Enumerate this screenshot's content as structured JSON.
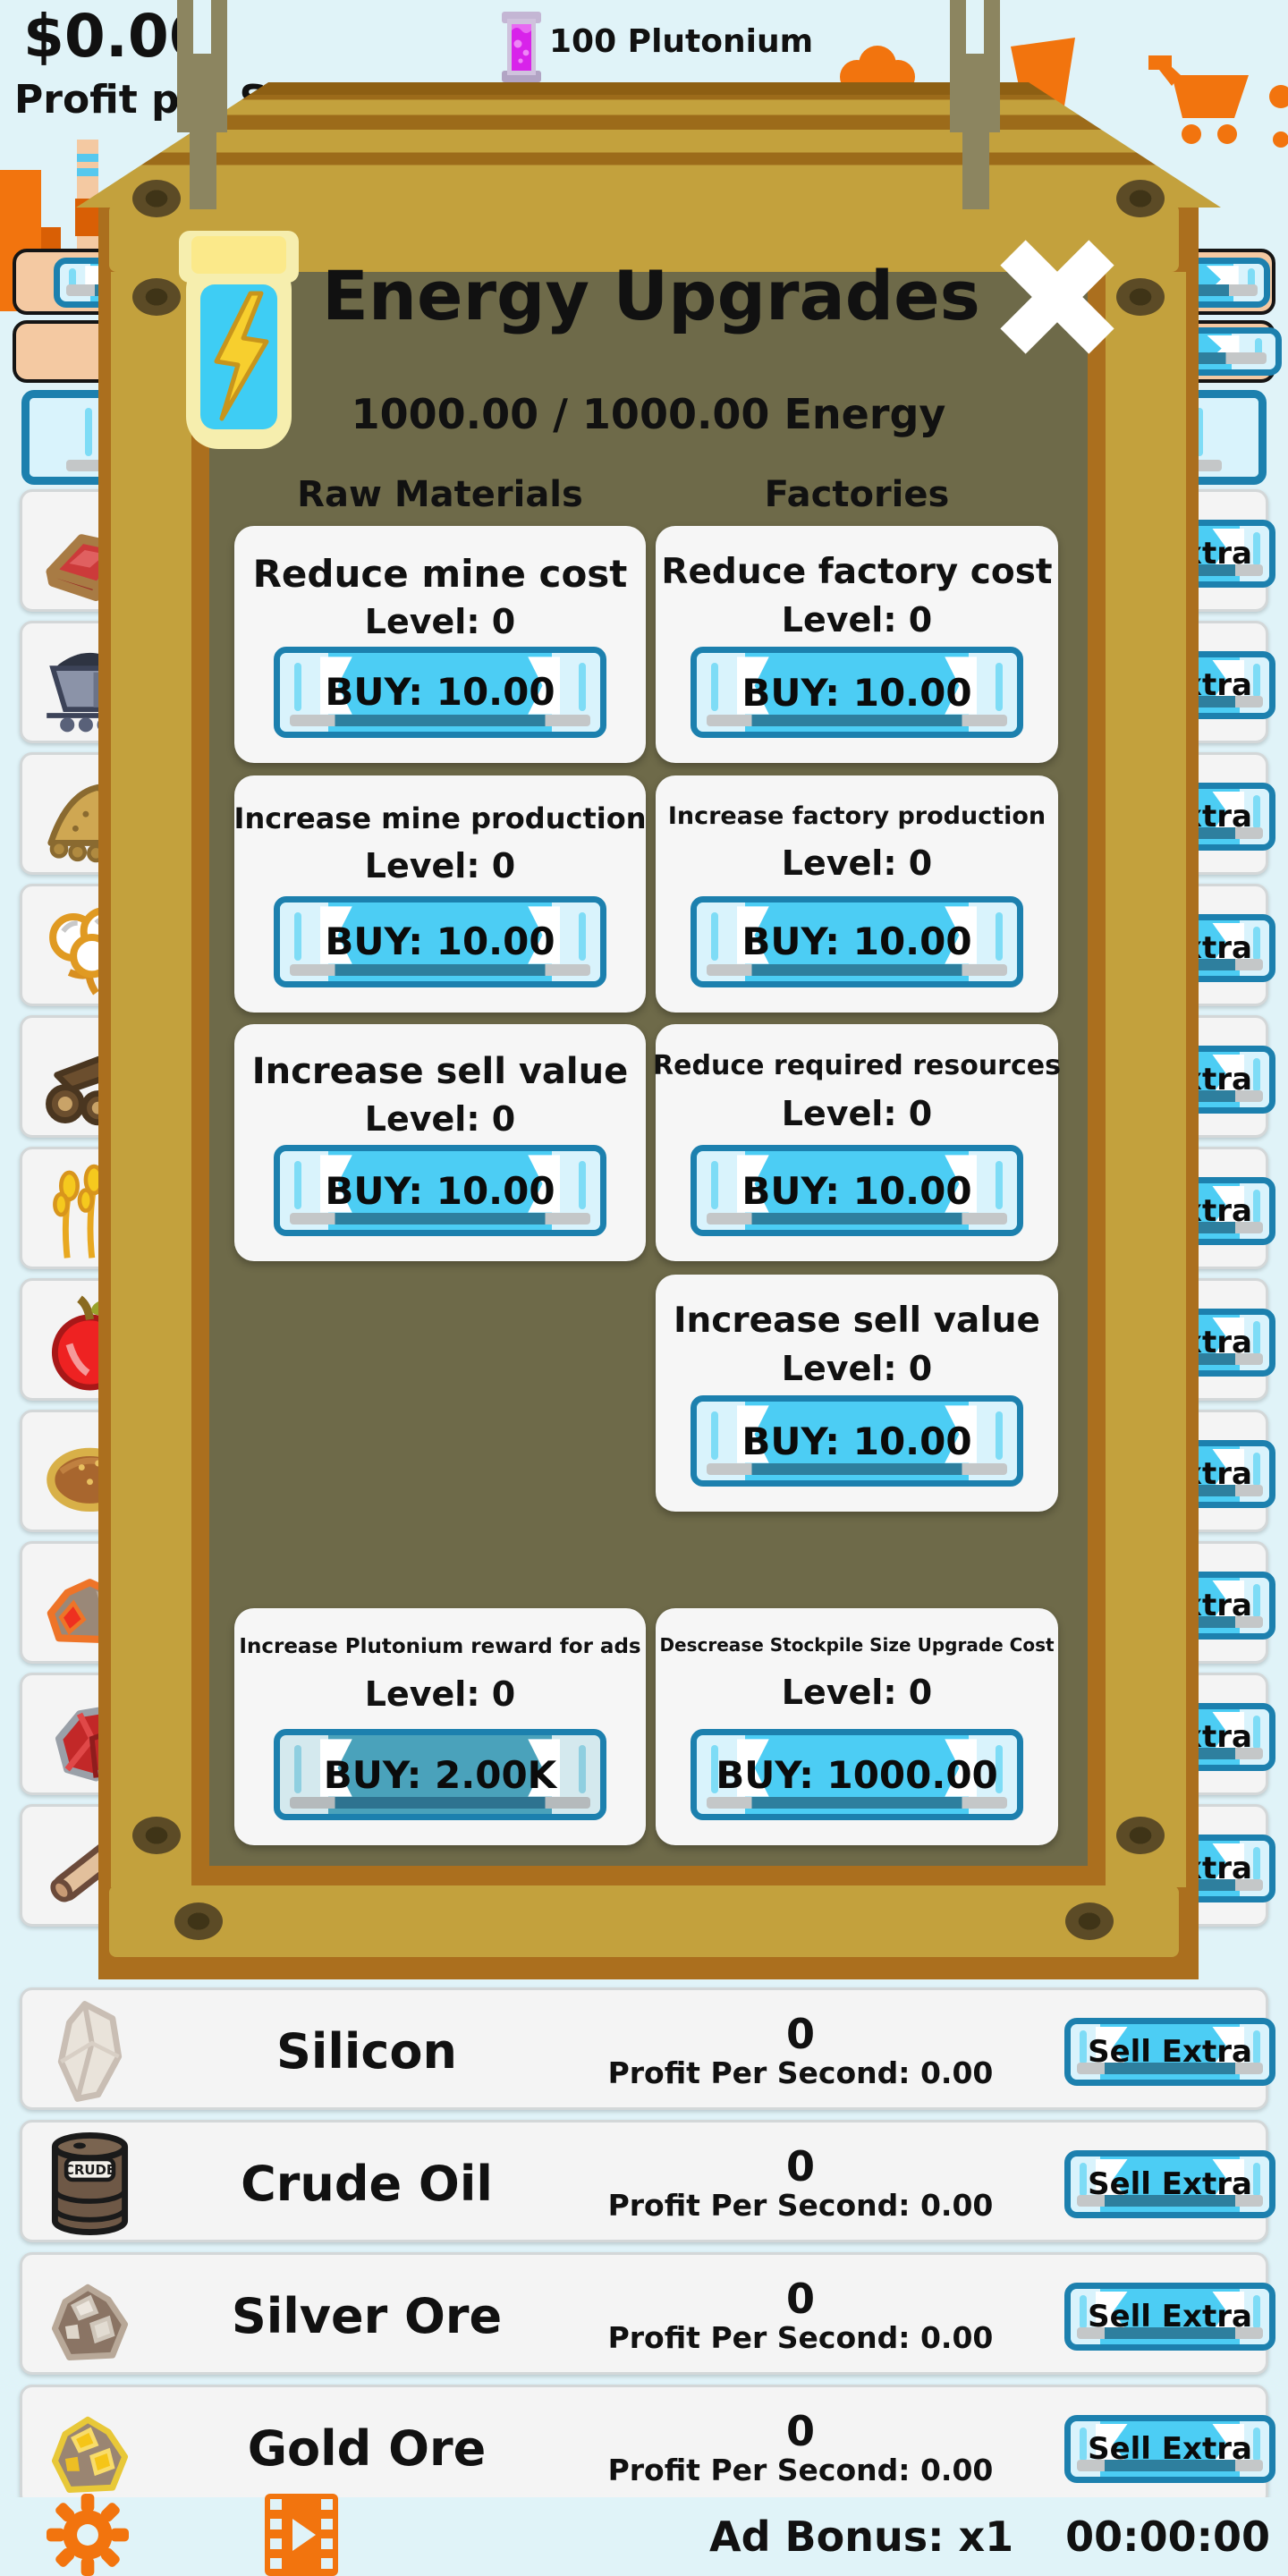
{
  "hud": {
    "money": "$0.00",
    "profit_label": "Profit per S",
    "plutonium_count": "100 Plutonium"
  },
  "modal": {
    "title": "Energy Upgrades",
    "energy_status": "1000.00 / 1000.00 Energy",
    "column_headers": [
      "Raw Materials",
      "Factories"
    ],
    "cards": [
      {
        "title": "Reduce mine cost",
        "level": "Level: 0",
        "buy": "BUY: 10.00",
        "col": 0,
        "row": 0
      },
      {
        "title": "Reduce factory cost",
        "level": "Level: 0",
        "buy": "BUY: 10.00",
        "col": 1,
        "row": 0
      },
      {
        "title": "Increase mine production",
        "level": "Level: 0",
        "buy": "BUY: 10.00",
        "col": 0,
        "row": 1
      },
      {
        "title": "Increase factory production",
        "level": "Level: 0",
        "buy": "BUY: 10.00",
        "col": 1,
        "row": 1
      },
      {
        "title": "Increase sell value",
        "level": "Level: 0",
        "buy": "BUY: 10.00",
        "col": 0,
        "row": 2
      },
      {
        "title": "Reduce required resources",
        "level": "Level: 0",
        "buy": "BUY: 10.00",
        "col": 1,
        "row": 2
      },
      {
        "title": "Increase sell value",
        "level": "Level: 0",
        "buy": "BUY: 10.00",
        "col": 1,
        "row": 3
      },
      {
        "title": "Increase Plutonium reward for ads",
        "level": "Level: 0",
        "buy": "BUY: 2.00K",
        "col": 0,
        "row": 4,
        "muted": true
      },
      {
        "title": "Descrease Stockpile Size Upgrade Cost",
        "level": "Level: 0",
        "buy": "BUY: 1000.00",
        "col": 1,
        "row": 4
      }
    ]
  },
  "resources": {
    "sell_button_label": "Sell Extra",
    "crude_barrel_label": "CRUDE",
    "visible_rows": [
      {
        "name": "Silicon",
        "count": "0",
        "profit": "Profit Per Second: 0.00",
        "icon": "silicon"
      },
      {
        "name": "Crude Oil",
        "count": "0",
        "profit": "Profit Per Second: 0.00",
        "icon": "crude-oil"
      },
      {
        "name": "Silver Ore",
        "count": "0",
        "profit": "Profit Per Second: 0.00",
        "icon": "silver-ore"
      },
      {
        "name": "Gold Ore",
        "count": "0",
        "profit": "Profit Per Second: 0.00",
        "icon": "gold-ore"
      }
    ],
    "hidden_row_icons": [
      "ingot",
      "coal-cart",
      "sand",
      "cotton",
      "logs",
      "wheat",
      "apple",
      "bread",
      "copper-ore",
      "ruby",
      "stick"
    ]
  },
  "footer": {
    "ad_bonus": "Ad Bonus: x1",
    "timer": "00:00:00"
  },
  "icons": [
    "energy-jar-icon",
    "close-icon",
    "plutonium-vial-icon",
    "cart-icon",
    "gear-icon",
    "ad-video-icon",
    "factory-icon"
  ],
  "colors": {
    "accent_orange": "#f07010",
    "button_blue_border": "#1c80ae",
    "button_cyan": "#4ccdf4",
    "button_pale": "#d9f3fc",
    "crate_gold": "#c3a13d",
    "crate_brown": "#9c6b1a",
    "crate_frame": "#ab6f1e",
    "panel_olive": "#6e6a49",
    "page_bg": "#e0f3f8",
    "peach_row": "#f4c9a2"
  }
}
